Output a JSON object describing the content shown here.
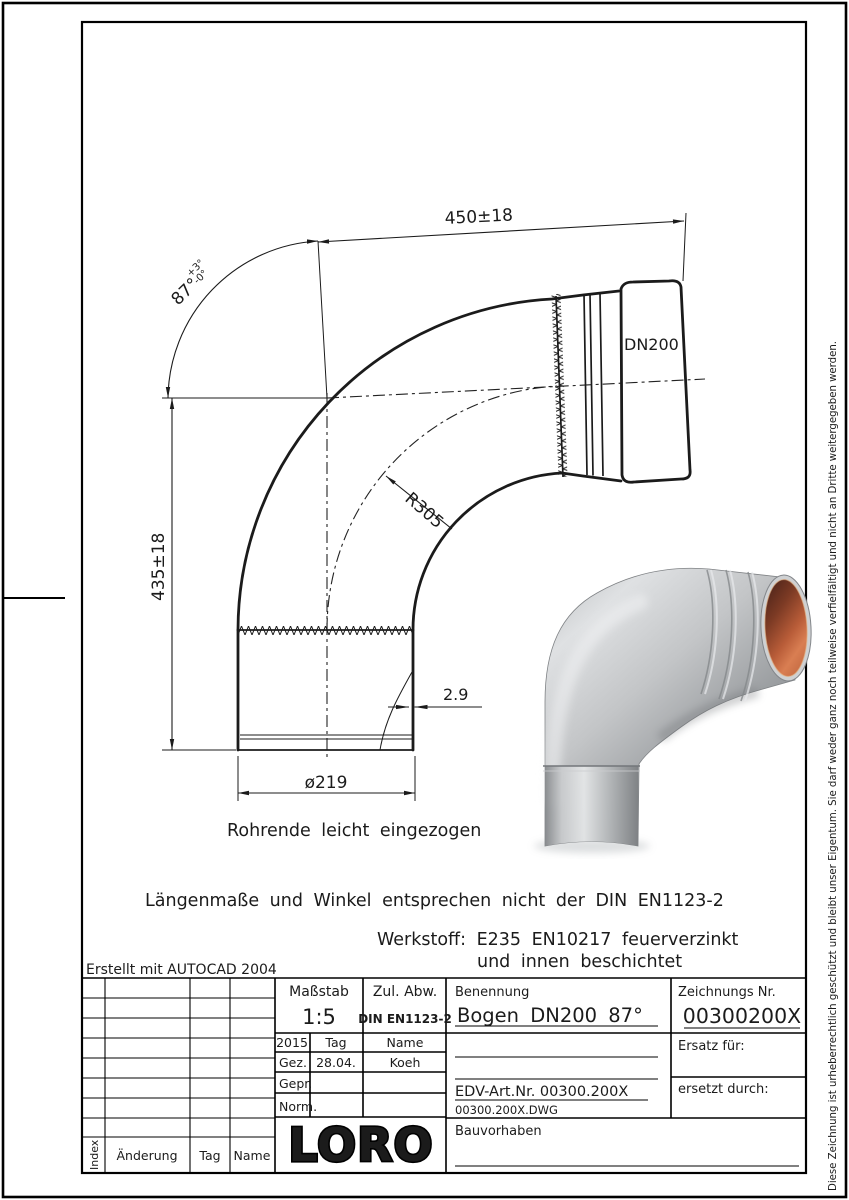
{
  "dims": {
    "top": "450±18",
    "left": "435±18",
    "angle": "87°",
    "angle_plus": "+3°",
    "angle_minus": "-0°",
    "dn": "DN200",
    "radius": "R305",
    "wall": "2.9",
    "dia": "ø219"
  },
  "notes": {
    "pipe_end": "Rohrende leicht eingezogen",
    "din": "Längenmaße und Winkel entsprechen nicht der DIN EN1123-2",
    "werkstoff1": "Werkstoff:  E235 EN10217 feuerverzinkt",
    "werkstoff2": "und innen beschichtet",
    "created": "Erstellt mit AUTOCAD 2004"
  },
  "title_block": {
    "masstab_label": "Maßstab",
    "masstab_value": "1:5",
    "abw_label": "Zul. Abw.",
    "abw_value": "DIN EN1123-2",
    "benennung_label": "Benennung",
    "benennung_value": "Bogen DN200 87°",
    "zeichnung_label": "Zeichnungs Nr.",
    "zeichnung_value": "00300200X",
    "year": "2015",
    "tag_label": "Tag",
    "name_label": "Name",
    "gez_label": "Gez.",
    "gez_tag": "28.04.",
    "gez_name": "Koeh",
    "gepr_label": "Gepr.",
    "norm_label": "Norm.",
    "edv": "EDV-Art.Nr. 00300.200X",
    "dwg": "00300.200X.DWG",
    "ersatz_label": "Ersatz für:",
    "ersetzt_label": "ersetzt durch:",
    "bauvorhaben_label": "Bauvorhaben",
    "logo": "LORO",
    "index_label": "Index",
    "aenderung_label": "Änderung",
    "tag2_label": "Tag",
    "name2_label": "Name"
  },
  "copyright": "Diese Zeichnung ist urheberrechtlich geschützt und bleibt unser Eigentum. Sie darf weder ganz noch teilweise verfielfältigt und nicht an Dritte weitergegeben werden.",
  "colors": {
    "line": "#1b1b1b",
    "metal_light": "#e6e8e9",
    "metal_dark": "#75787b",
    "copper": "#b85c38",
    "copper_dark": "#4e241a"
  }
}
